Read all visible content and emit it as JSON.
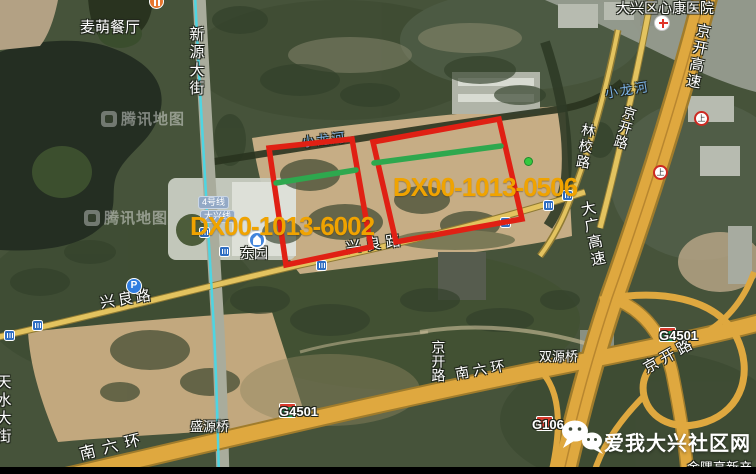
{
  "colors": {
    "parcel_outline": "#e02014",
    "parcel_divider": "#2ea84e",
    "parcel_label": "#f0a300",
    "metro_line": "#49d7e6",
    "river_label": "#7db4e8",
    "highway_fill": "#dfa83f",
    "road_fill": "#e3c35f"
  },
  "parcels": [
    {
      "label": "DX00-1013-6002"
    },
    {
      "label": "DX00-1013-0506"
    }
  ],
  "labels": {
    "restaurant": "麦萌餐厅",
    "hospital": "大兴区心康医院",
    "xinyuan_street": "新源大街",
    "jingkai_expressway": "京开高速",
    "jingkai_road_top": "京开路",
    "linxiao_road": "林校路",
    "xiaolonghe_left": "小龙河",
    "xiaolonghe_right": "小龙河",
    "dongyuan_station": "东园",
    "line4_badge": "4号线",
    "daxing_line_badge": "大兴线",
    "xingliang_road_west": "兴良路",
    "xingliang_road_east": "兴良路",
    "daguang_expressway": "大广高速",
    "tianshui_street": "天水大街",
    "shengyuan_bridge": "盛源桥",
    "south_6th_ring_west": "南六环",
    "south_6th_ring_east": "南六环",
    "jingkai_road_mid": "京开路",
    "shuangyuan_bridge": "双源桥",
    "jingkai_road_southeast": "京开路",
    "jinyu_partial": "金隅高新产",
    "parking": "P",
    "ring_icon_glyph": "上"
  },
  "badges": {
    "g4501_west": "G4501",
    "g4501_east": "G4501",
    "g106": "G106"
  },
  "branding": {
    "community_site": "爱我大兴社区网",
    "watermark": "腾讯地图"
  }
}
